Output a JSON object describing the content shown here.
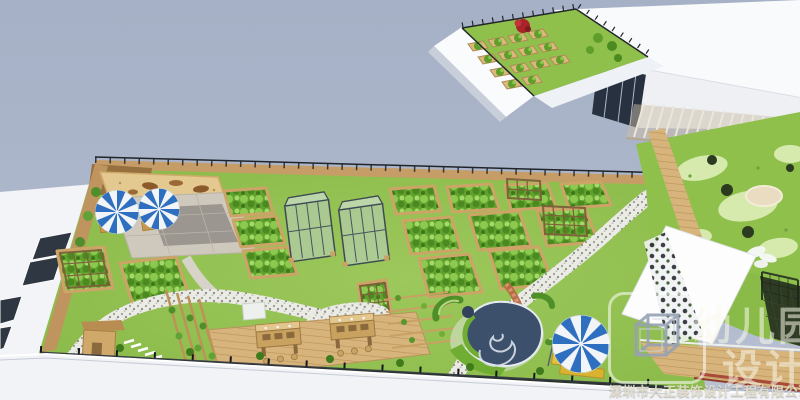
{
  "watermark": {
    "big_text_line1": "幼儿园",
    "big_text_line2": "设计",
    "company_name": "深圳市大正装饰设计工程有限公司",
    "logo_icon": "wireframe-cube-icon"
  },
  "palette": {
    "sky": "#aab4c8",
    "lawn_green": "#93c152",
    "play_lawn": "#8fc04c",
    "play_blob": "#d7eaae",
    "planter_wood": "#d3ab6e",
    "planter_green": "#61a22e",
    "sand": "#e3c98f",
    "pavement": "#cfc9bd",
    "gravel_path": "#ebebe5",
    "deck_wood": "#d6b47c",
    "umbrella_blue": "#2e6fc0",
    "fence_dark": "#23282e",
    "building_white": "#f8fafc",
    "glass_dark": "#27313f",
    "accent_red_plant": "#a8232a",
    "lounger_yellow": "#e6c23c",
    "sculpture_navy": "#3c4f6b",
    "brick_path": "#b4663f"
  },
  "scene": {
    "type": "3d-aerial-architectural-render",
    "areas": [
      {
        "id": "top-plot-garden",
        "label": "detached rooftop planting plot with raised beds and red tree"
      },
      {
        "id": "right-building",
        "label": "white building block with glazing, pergola and play lawn"
      },
      {
        "id": "play-area",
        "label": "lawn with organic play mounds, sand pit and shrubs"
      },
      {
        "id": "main-roof-garden",
        "label": "large rooftop farm garden with planter beds"
      },
      {
        "id": "umbrella-patio",
        "label": "paved patio with two striped parasols and sand play corner"
      },
      {
        "id": "greenhouses",
        "label": "two glass greenhouse frames"
      },
      {
        "id": "planter-beds",
        "label": "trapezoidal raised vegetable beds"
      },
      {
        "id": "gravel-paths",
        "label": "winding speckled gravel walkways"
      },
      {
        "id": "wooden-deck",
        "label": "timber deck with planting work tables and stools"
      },
      {
        "id": "vine-trellises",
        "label": "climbing vine trellis rows"
      },
      {
        "id": "playhouse",
        "label": "small timber play house"
      },
      {
        "id": "snail-sculpture",
        "label": "spiral snail play sculpture with hedge crescents"
      },
      {
        "id": "leisure-parasol",
        "label": "striped parasol with yellow loungers"
      },
      {
        "id": "perimeter-fence",
        "label": "dark mesh safety fence"
      },
      {
        "id": "bottom-parapet",
        "label": "white parapet edge of building"
      }
    ]
  }
}
